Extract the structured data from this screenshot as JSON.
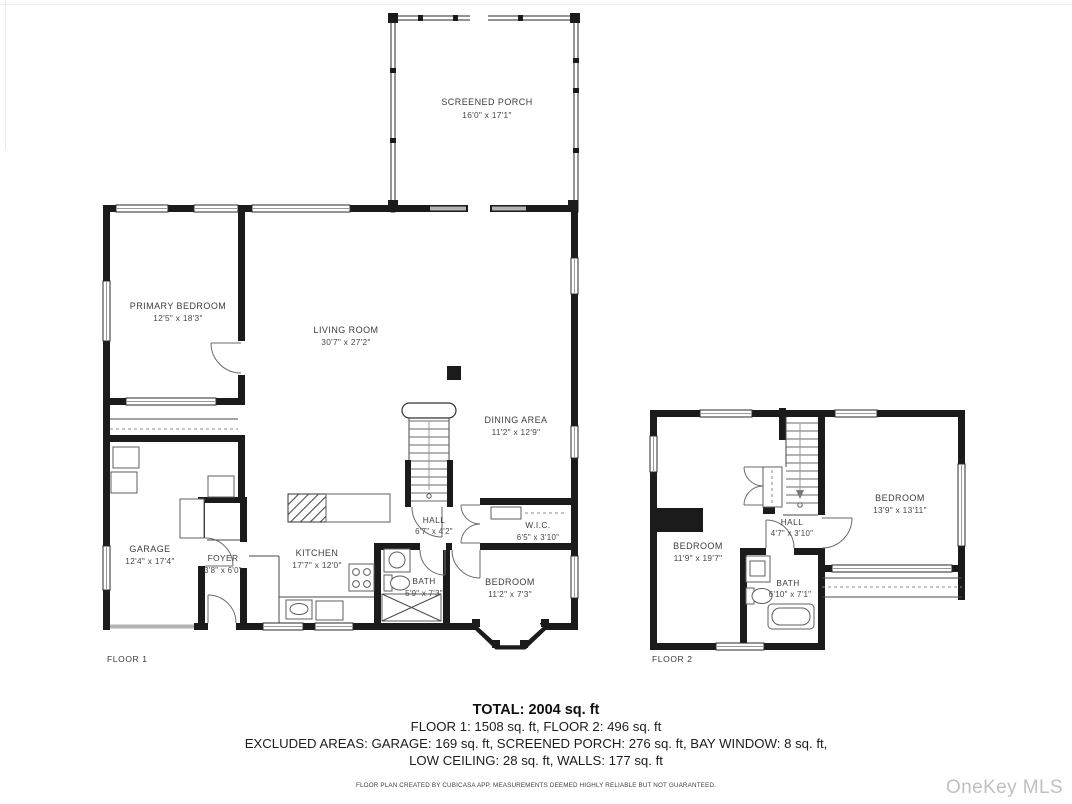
{
  "page": {
    "watermark": "OneKey MLS"
  },
  "floor1": {
    "label": "FLOOR 1",
    "rooms": [
      {
        "name": "SCREENED PORCH",
        "dims": "16'0\" x 17'1\""
      },
      {
        "name": "PRIMARY BEDROOM",
        "dims": "12'5\" x 18'3\""
      },
      {
        "name": "LIVING ROOM",
        "dims": "30'7\" x 27'2\""
      },
      {
        "name": "DINING AREA",
        "dims": "11'2\" x 12'9\""
      },
      {
        "name": "GARAGE",
        "dims": "12'4\" x 17'4\""
      },
      {
        "name": "FOYER",
        "dims": "3'8\" x 6'0\""
      },
      {
        "name": "KITCHEN",
        "dims": "17'7\" x 12'0\""
      },
      {
        "name": "HALL",
        "dims": "6'7\" x 4'2\""
      },
      {
        "name": "W.I.C.",
        "dims": "6'5\" x 3'10\""
      },
      {
        "name": "BATH",
        "dims": "5'9\" x 7'3\""
      },
      {
        "name": "BEDROOM",
        "dims": "11'2\" x 7'3\""
      }
    ]
  },
  "floor2": {
    "label": "FLOOR 2",
    "rooms": [
      {
        "name": "BEDROOM",
        "dims": "11'9\" x 19'7\""
      },
      {
        "name": "HALL",
        "dims": "4'7\" x 3'10\""
      },
      {
        "name": "BATH",
        "dims": "6'10\" x 7'1\""
      },
      {
        "name": "BEDROOM",
        "dims": "13'9\" x 13'11\""
      }
    ]
  },
  "summary": {
    "total": "TOTAL: 2004 sq. ft",
    "floors": "FLOOR 1: 1508 sq. ft, FLOOR 2: 496 sq. ft",
    "excluded1": "EXCLUDED AREAS: GARAGE: 169 sq. ft, SCREENED PORCH: 276 sq. ft, BAY WINDOW: 8 sq. ft,",
    "excluded2": "LOW CEILING: 28 sq. ft, WALLS: 177 sq. ft",
    "disclaimer": "FLOOR PLAN CREATED BY CUBICASA APP. MEASUREMENTS DEEMED HIGHLY RELIABLE BUT NOT GUARANTEED."
  },
  "colors": {
    "wall": "#1b1b1b",
    "watermark": "#c0c0c0"
  }
}
